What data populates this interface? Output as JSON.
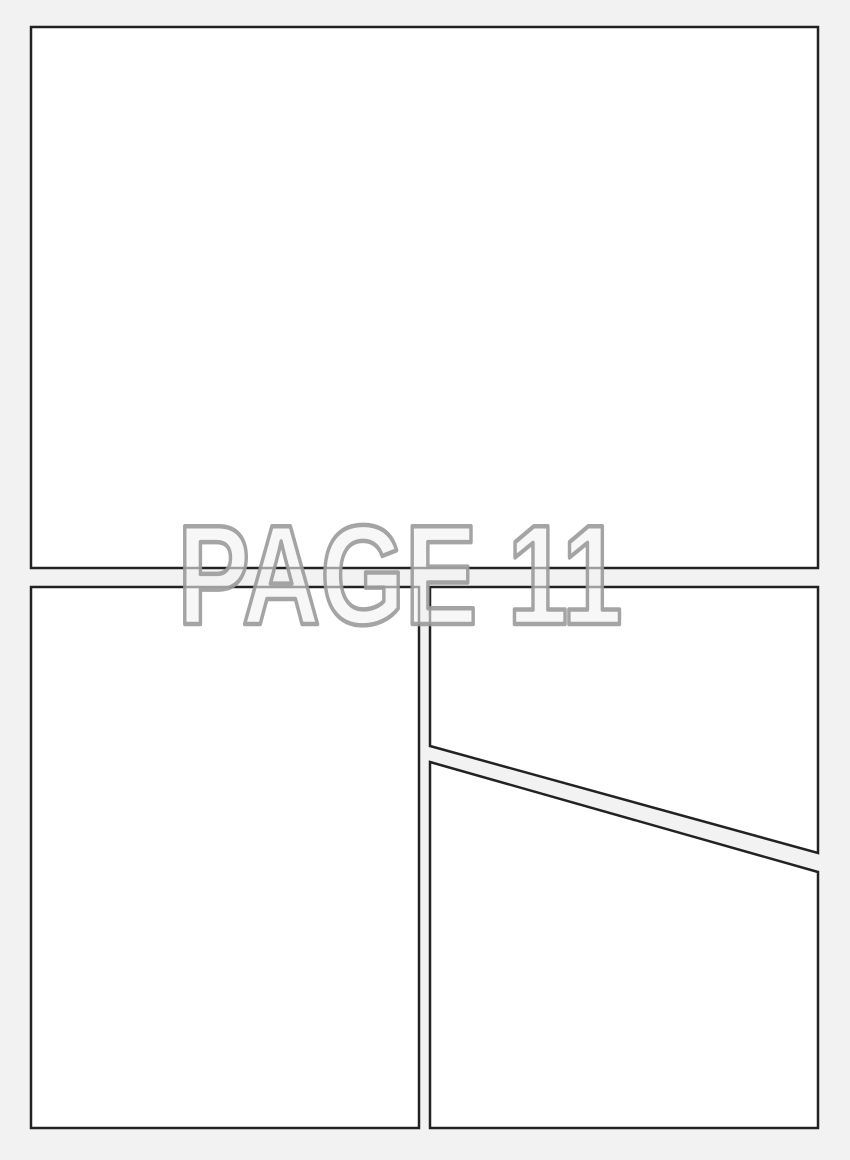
{
  "page_label": "PAGE 11",
  "colors": {
    "background": "#f2f2f2",
    "panel_fill": "#ffffff",
    "panel_border": "#222222",
    "label_fill": "#f2f2f2",
    "label_outline": "#9a9a9a"
  }
}
